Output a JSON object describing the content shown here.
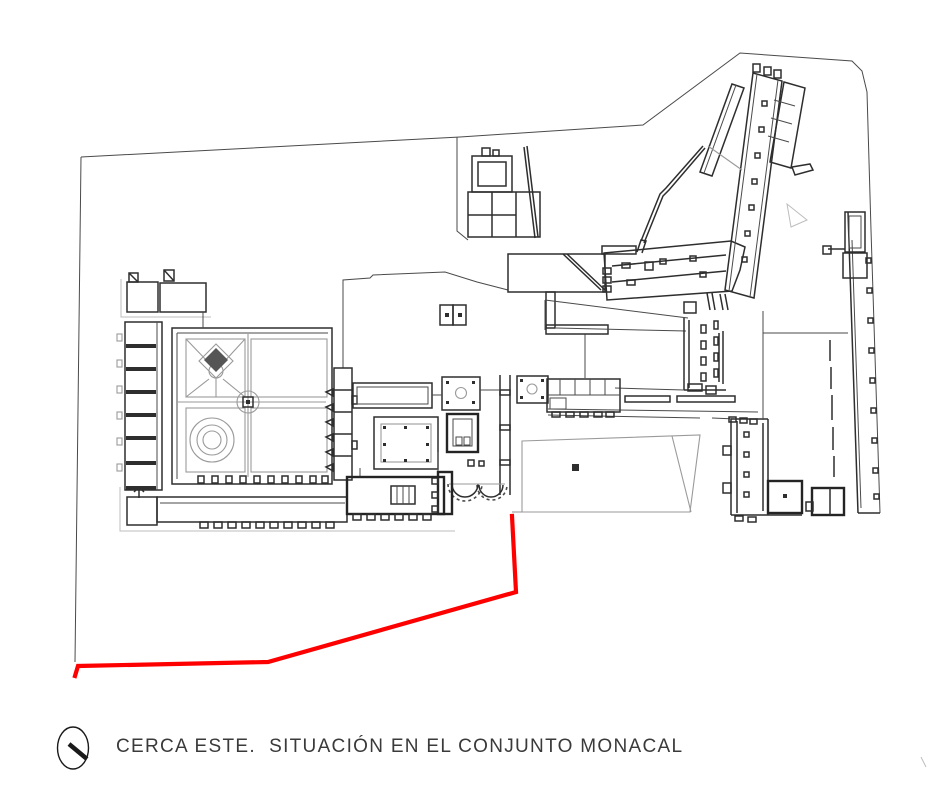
{
  "page": {
    "width": 933,
    "height": 785,
    "background": "#ffffff"
  },
  "caption": {
    "icon": "north-indicator-icon",
    "text": "CERCA ESTE.  SITUACIÓN EN EL CONJUNTO MONACAL"
  },
  "colors": {
    "fence_red": "#ff0000",
    "wall_dark": "#2e2e2e",
    "thin_line": "#4a4a4a",
    "garden_gray": "#9a9a9a",
    "light_gray": "#bdbdbd",
    "caption_text": "#3a3a3a",
    "background": "#ffffff"
  },
  "fence": {
    "label": "cerca-este-highlight",
    "points": "512,516 516,592 268,662 78,666 75,676",
    "stroke_width": 4.2
  }
}
